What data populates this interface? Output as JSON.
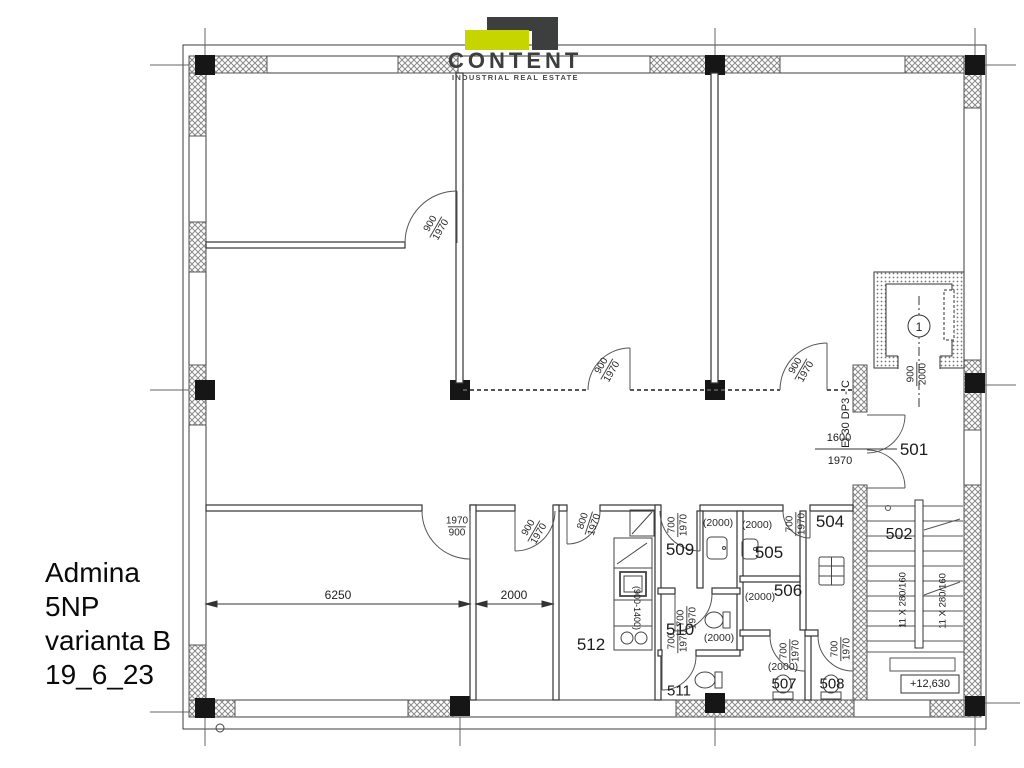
{
  "logo": {
    "name": "CONTENT",
    "tagline": "INDUSTRIAL REAL ESTATE",
    "accent_color": "#c6d400",
    "dark_color": "#3d3e3e"
  },
  "title_block": {
    "lines": [
      "Admina",
      "5NP",
      "varianta B",
      "19_6_23"
    ]
  },
  "rooms": {
    "r501": "501",
    "r502": "502",
    "r504": "504",
    "r505": "505",
    "r506": "506",
    "r507": "507",
    "r508": "508",
    "r509": "509",
    "r510": "510",
    "r511": "511",
    "r512": "512"
  },
  "labels": {
    "n700": "700",
    "n800": "800",
    "n900": "900",
    "n1600": "1600",
    "n1970": "1970",
    "n2000": "2000",
    "par2000": "(2000)",
    "counter_range": "(900-1400)",
    "stair_flight": "11 X 280/160",
    "fire_rating": "EI 30 DP3 - C",
    "level": "+12,630",
    "dim_6250": "6250",
    "dim_2000": "2000",
    "elevator_no": "1"
  }
}
